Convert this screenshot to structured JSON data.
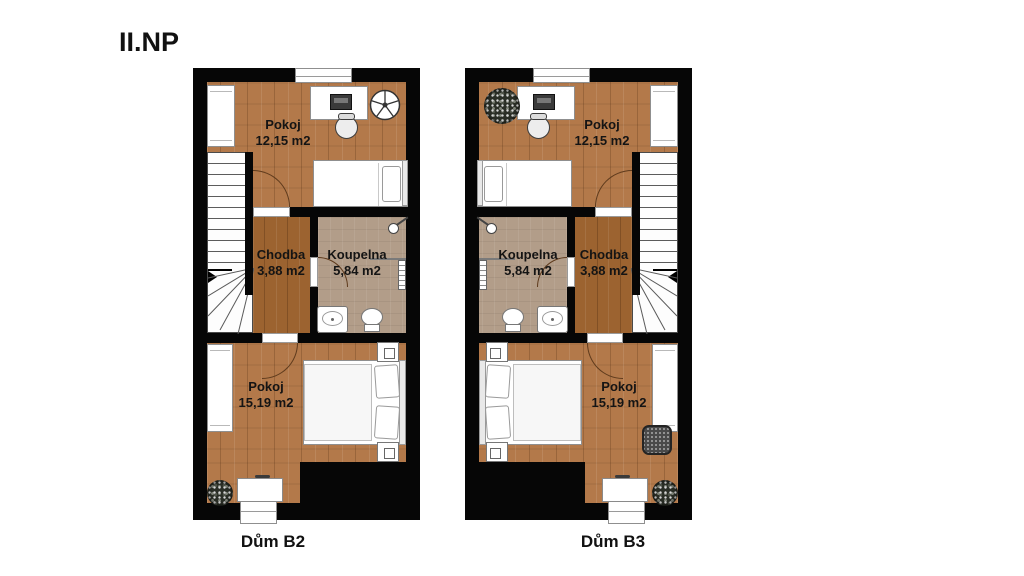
{
  "title": "II.NP",
  "plans": [
    {
      "label": "Dům B2",
      "rooms": [
        {
          "name": "Pokoj",
          "area": "12,15 m2"
        },
        {
          "name": "Chodba",
          "area": "3,88 m2"
        },
        {
          "name": "Koupelna",
          "area": "5,84 m2"
        },
        {
          "name": "Pokoj",
          "area": "15,19 m2"
        }
      ]
    },
    {
      "label": "Dům B3",
      "rooms": [
        {
          "name": "Pokoj",
          "area": "12,15 m2"
        },
        {
          "name": "Chodba",
          "area": "3,88 m2"
        },
        {
          "name": "Koupelna",
          "area": "5,84 m2"
        },
        {
          "name": "Pokoj",
          "area": "15,19 m2"
        }
      ]
    }
  ],
  "colors": {
    "wall": "#060606",
    "wood": "#b3794a",
    "wood_dark": "#9c6330",
    "bath_tile": "#b29d89"
  }
}
